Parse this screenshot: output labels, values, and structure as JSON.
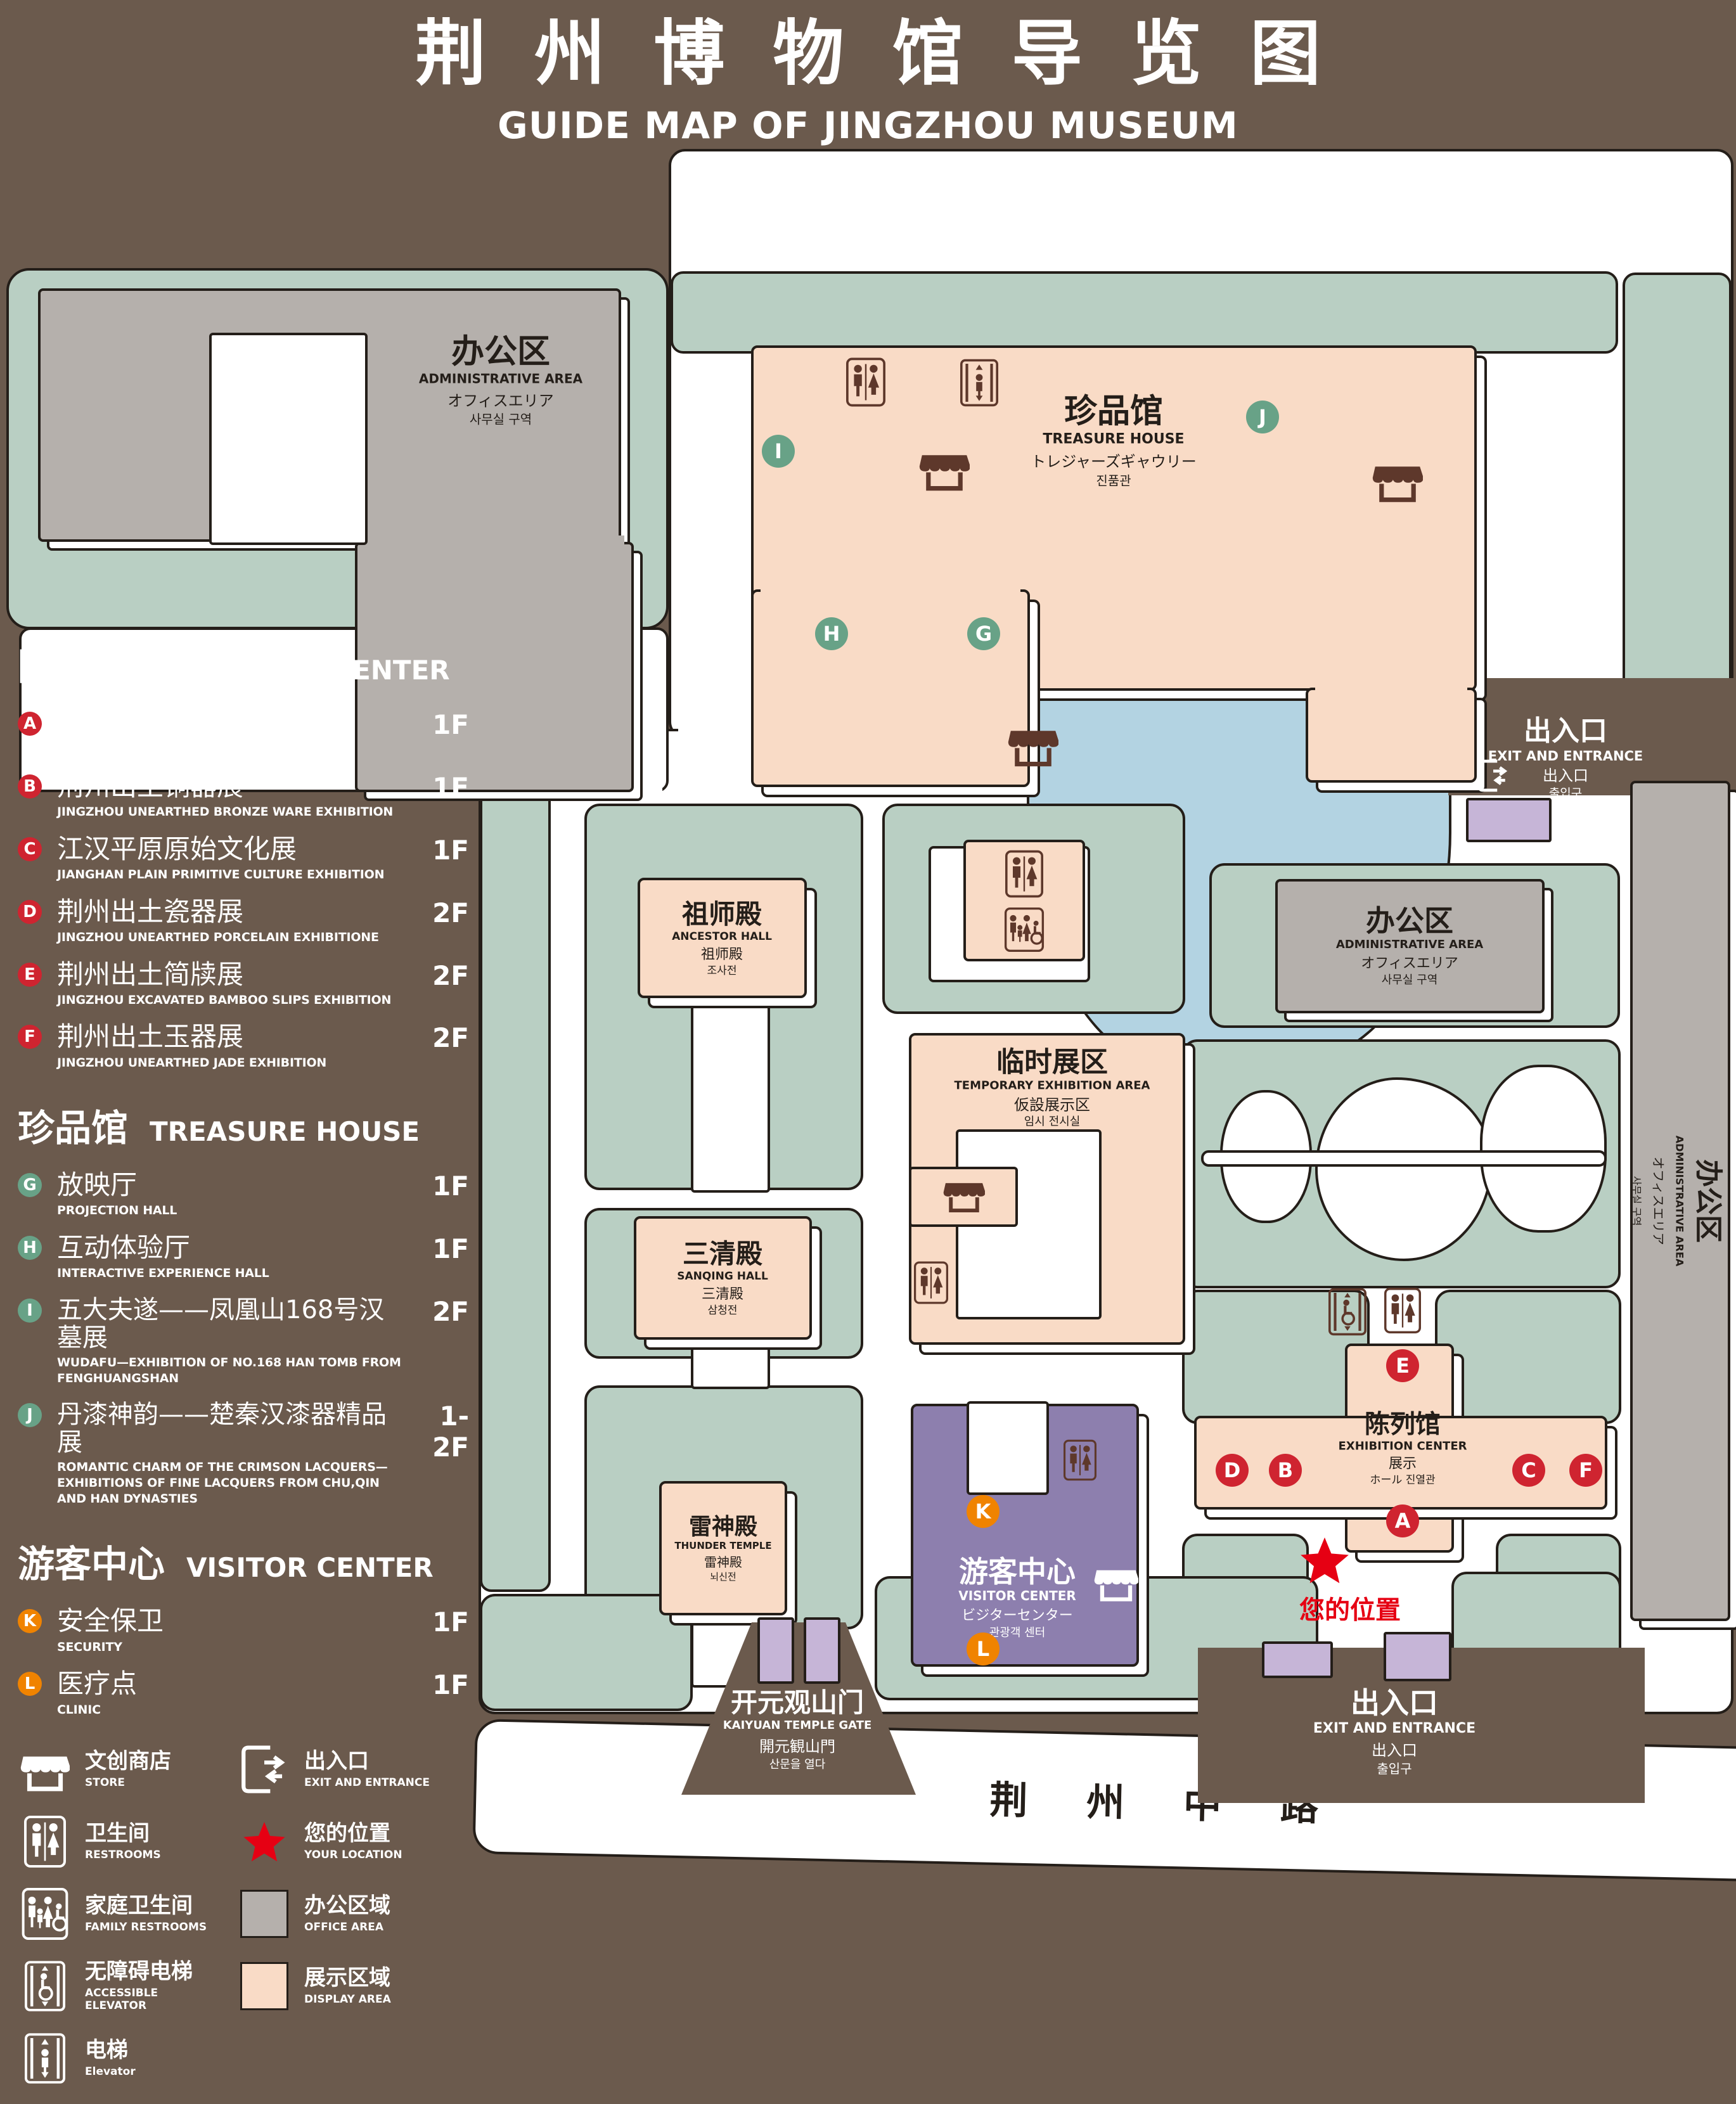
{
  "title": {
    "zh": "荆州博物馆导览图",
    "en": "GUIDE MAP OF JINGZHOU MUSEUM"
  },
  "colors": {
    "background": "#6b5a4d",
    "lawn": "#b9cfc3",
    "display_area": "#f9dbc6",
    "office_area": "#b5b0ac",
    "lake": "#b3d3e2",
    "visitor_center": "#8d7fae",
    "gate_purple": "#c6b5d7",
    "marker_red": "#cf2430",
    "marker_green": "#68a287",
    "marker_orange": "#f08300",
    "icon_brown": "#5e382b",
    "location_red": "#e60013"
  },
  "legend": {
    "sections": [
      {
        "zh": "陈列馆",
        "en": "EXHIBITION CENTER",
        "items": [
          {
            "letter": "A",
            "zh": "《火中的凤凰》壁画",
            "en": "THE PHOENIX IN FIRE \"MURAL PAINTING",
            "floor": "1F"
          },
          {
            "letter": "B",
            "zh": "荆州出土铜器展",
            "en": "JINGZHOU UNEARTHED BRONZE WARE EXHIBITION",
            "floor": "1F"
          },
          {
            "letter": "C",
            "zh": "江汉平原原始文化展",
            "en": "JIANGHAN PLAIN PRIMITIVE CULTURE EXHIBITION",
            "floor": "1F"
          },
          {
            "letter": "D",
            "zh": "荆州出土瓷器展",
            "en": "JINGZHOU UNEARTHED PORCELAIN EXHIBITIONE",
            "floor": "2F"
          },
          {
            "letter": "E",
            "zh": "荆州出土简牍展",
            "en": "JINGZHOU EXCAVATED BAMBOO SLIPS EXHIBITION",
            "floor": "2F"
          },
          {
            "letter": "F",
            "zh": "荆州出土玉器展",
            "en": "JINGZHOU UNEARTHED JADE EXHIBITION",
            "floor": "2F"
          }
        ]
      },
      {
        "zh": "珍品馆",
        "en": "TREASURE HOUSE",
        "items": [
          {
            "letter": "G",
            "zh": "放映厅",
            "en": "PROJECTION HALL",
            "floor": "1F"
          },
          {
            "letter": "H",
            "zh": "互动体验厅",
            "en": "INTERACTIVE EXPERIENCE HALL",
            "floor": "1F"
          },
          {
            "letter": "I",
            "zh": "五大夫遂——凤凰山168号汉墓展",
            "en": "WUDAFU—EXHIBITION OF NO.168 HAN TOMB FROM FENGHUANGSHAN",
            "floor": "2F"
          },
          {
            "letter": "J",
            "zh": "丹漆神韵——楚秦汉漆器精品展",
            "en": "ROMANTIC CHARM OF THE CRIMSON LACQUERS—EXHIBITIONS OF FINE LACQUERS FROM CHU,QIN AND HAN DYNASTIES",
            "floor": "1-2F"
          }
        ]
      },
      {
        "zh": "游客中心",
        "en": "VISITOR CENTER",
        "items": [
          {
            "letter": "K",
            "zh": "安全保卫",
            "en": "SECURITY",
            "floor": "1F"
          },
          {
            "letter": "L",
            "zh": "医疗点",
            "en": "CLINIC",
            "floor": "1F"
          }
        ]
      }
    ],
    "symbols": {
      "store": {
        "zh": "文创商店",
        "en": "STORE"
      },
      "restrooms": {
        "zh": "卫生间",
        "en": "RESTROOMS"
      },
      "family_restrooms": {
        "zh": "家庭卫生间",
        "en": "FAMILY RESTROOMS"
      },
      "accessible_elevator": {
        "zh": "无障碍电梯",
        "en": "ACCESSIBLE ELEVATOR"
      },
      "elevator": {
        "zh": "电梯",
        "en": "Elevator"
      },
      "exit": {
        "zh": "出入口",
        "en": "EXIT AND ENTRANCE"
      },
      "your_location": {
        "zh": "您的位置",
        "en": "YOUR LOCATION"
      },
      "office_area": {
        "zh": "办公区域",
        "en": "OFFICE AREA"
      },
      "display_area": {
        "zh": "展示区域",
        "en": "DISPLAY AREA"
      }
    }
  },
  "map": {
    "admin_topleft": {
      "zh": "办公区",
      "en": "ADMINISTRATIVE AREA",
      "ja": "オフィスエリア",
      "ko": "사무실 구역"
    },
    "admin_right": {
      "zh": "办公区",
      "en": "ADMINISTRATIVE AREA",
      "ja": "オフィスエリア",
      "ko": "사무실 구역"
    },
    "admin_strip": {
      "zh": "办公区",
      "en": "ADMINISTRATIVE AREA",
      "ja": "オフィスエリア",
      "ko": "사무실 구역"
    },
    "treasure_house": {
      "zh": "珍品馆",
      "en": "TREASURE HOUSE",
      "ja": "トレジャーズギャウリー",
      "ko": "진품관"
    },
    "ancestor_hall": {
      "zh": "祖师殿",
      "en": "ANCESTOR HALL",
      "ja": "祖师殿",
      "ko": "조사전"
    },
    "sanqing_hall": {
      "zh": "三清殿",
      "en": "SANQING HALL",
      "ja": "三清殿",
      "ko": "삼청전"
    },
    "temporary_area": {
      "zh": "临时展区",
      "en": "TEMPORARY EXHIBITION AREA",
      "ja": "仮設展示区",
      "ko": "임시 전시실"
    },
    "thunder_temple": {
      "zh": "雷神殿",
      "en": "THUNDER TEMPLE",
      "ja": "雷神殿",
      "ko": "뇌신전"
    },
    "visitor_center": {
      "zh": "游客中心",
      "en": "VISITOR CENTER",
      "ja": "ビジターセンター",
      "ko": "관광객 센터"
    },
    "kaiyuan_gate": {
      "zh": "开元观山门",
      "en": "KAIYUAN TEMPLE GATE",
      "ja": "開元観山門",
      "ko": "산문을 열다"
    },
    "exhibition_center": {
      "zh": "陈列馆",
      "en": "EXHIBITION CENTER",
      "l3": "展示",
      "l4": "ホール 진열관"
    },
    "exit_right": {
      "zh": "出入口",
      "en": "EXIT AND ENTRANCE",
      "zh2": "出入口",
      "ko": "출입구"
    },
    "exit_bottom": {
      "zh": "出入口",
      "en": "EXIT AND ENTRANCE",
      "zh2": "出入口",
      "ko": "출입구"
    },
    "road": "荆 州 中 路",
    "your_location": "您的位置"
  }
}
